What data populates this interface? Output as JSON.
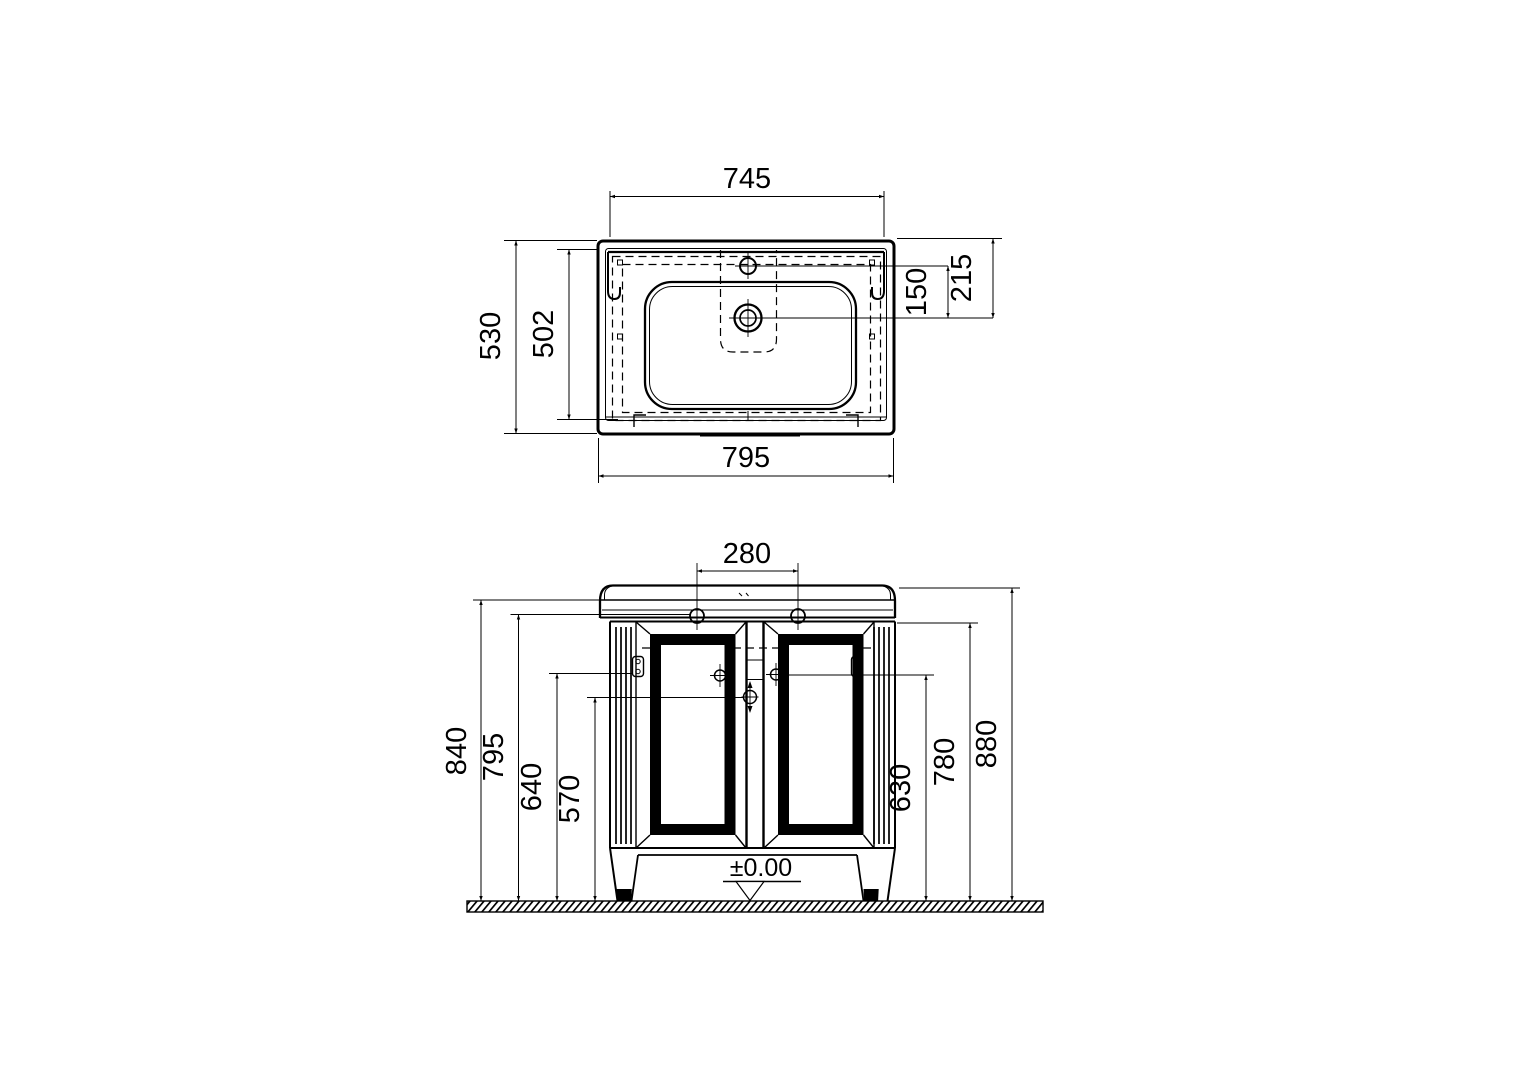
{
  "drawing": {
    "top_view": {
      "width_top": "745",
      "width_bottom": "795",
      "depth_outer": "530",
      "depth_inner": "502",
      "faucet_to_drain": "150",
      "edge_to_drain": "215"
    },
    "front_view": {
      "hole_spacing": "280",
      "height_840": "840",
      "height_795": "795",
      "height_640": "640",
      "height_570": "570",
      "height_630": "630",
      "height_780": "780",
      "height_880": "880",
      "floor_level": "±0.00"
    }
  }
}
